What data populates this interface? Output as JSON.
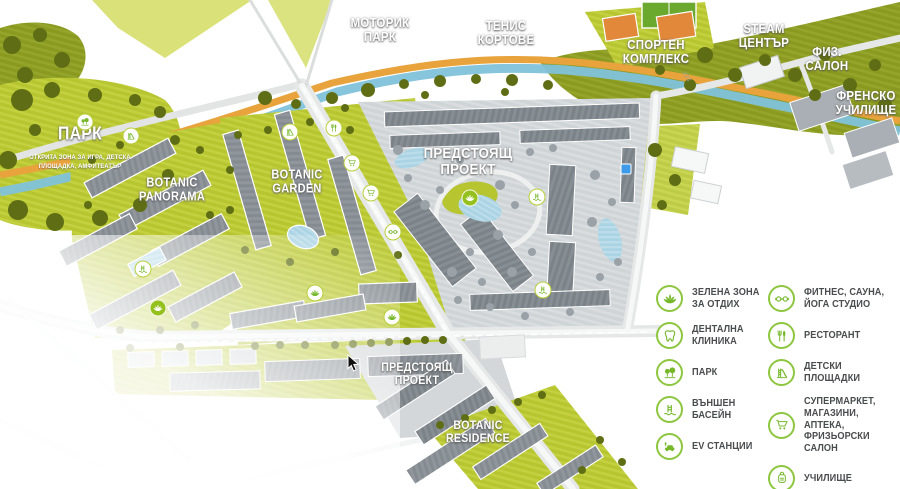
{
  "colors": {
    "accent_green": "#8dc63f",
    "icon_green": "#76b82a",
    "legend_text": "#4b4c4e",
    "lime": "#b7c531",
    "olive": "#8a991f",
    "tree_olive": "#5f6e15",
    "river_blue": "#7fc2da",
    "path_orange": "#e8a33d",
    "road_gray": "#e6e8e8",
    "building_gray": "#90969c",
    "upcoming_gray": "#cfd4d6",
    "pool_blue": "#aad4e4",
    "marker_ring": "#b9cf3a"
  },
  "map": {
    "area_labels": [
      {
        "id": "motorik-park",
        "text": "МОТОРИК\nПАРК",
        "x": 380,
        "y": 30,
        "size": 13
      },
      {
        "id": "tenis-kortove",
        "text": "ТЕНИС\nКОРТОВЕ",
        "x": 506,
        "y": 33,
        "size": 13
      },
      {
        "id": "sporten-kompleks",
        "text": "СПОРТЕН\nКОМПЛЕКС",
        "x": 656,
        "y": 52,
        "size": 13
      },
      {
        "id": "steam-centar",
        "text": "STEAM\nЦЕНТЪР",
        "x": 764,
        "y": 36,
        "size": 13
      },
      {
        "id": "fiz-salon",
        "text": "ФИЗ.\nСАЛОН",
        "x": 827,
        "y": 59,
        "size": 13
      },
      {
        "id": "frensko-uchilishte",
        "text": "ФРЕНСКО\nУЧИЛИЩЕ",
        "x": 866,
        "y": 103,
        "size": 13
      },
      {
        "id": "park",
        "text": "ПАРК",
        "x": 80,
        "y": 134,
        "size": 18
      },
      {
        "id": "park-subtitle",
        "text": "ОТКРИТА ЗОНА ЗА ИГРА, ДЕТСКА\nПЛОЩАДКА, АМФИТЕАТЪР",
        "x": 80,
        "y": 163,
        "size": 6.5,
        "variant": "sub"
      },
      {
        "id": "botanic-panorama",
        "text": "BOTANIC\nPANORAMA",
        "x": 172,
        "y": 190,
        "size": 12.5
      },
      {
        "id": "botanic-garden",
        "text": "BOTANIC\nGARDEN",
        "x": 297,
        "y": 182,
        "size": 12.5
      },
      {
        "id": "predstoyasht-proekt",
        "text": "ПРЕДСТОЯЩ\nПРОЕКТ",
        "x": 468,
        "y": 162,
        "size": 15
      },
      {
        "id": "predstoyasht-proekt-south",
        "text": "ПРЕДСТОЯЩ\nПРОЕКТ",
        "x": 417,
        "y": 374,
        "size": 12
      },
      {
        "id": "botanic-residence",
        "text": "BOTANIC\nRESIDENCE",
        "x": 478,
        "y": 432,
        "size": 12
      },
      {
        "id": "road-223",
        "text": "223",
        "x": 686,
        "y": 77,
        "size": 6,
        "variant": "road"
      }
    ],
    "markers": [
      {
        "icon": "park-trees",
        "x": 85,
        "y": 122,
        "variant": "white"
      },
      {
        "icon": "playground-slide",
        "x": 131,
        "y": 136,
        "variant": "white"
      },
      {
        "icon": "playground-slide",
        "x": 290,
        "y": 132,
        "variant": "white"
      },
      {
        "icon": "restaurant",
        "x": 334,
        "y": 128,
        "variant": "white"
      },
      {
        "icon": "supermarket-cart",
        "x": 352,
        "y": 163,
        "variant": "white"
      },
      {
        "icon": "supermarket-cart",
        "x": 371,
        "y": 193,
        "variant": "white"
      },
      {
        "icon": "dumbbell",
        "x": 393,
        "y": 232,
        "variant": "white"
      },
      {
        "icon": "pool-ladder",
        "x": 143,
        "y": 269,
        "variant": "white"
      },
      {
        "icon": "lotus",
        "x": 158,
        "y": 308,
        "variant": "green"
      },
      {
        "icon": "lotus",
        "x": 315,
        "y": 293,
        "variant": "white"
      },
      {
        "icon": "lotus",
        "x": 392,
        "y": 317,
        "variant": "white"
      },
      {
        "icon": "lotus",
        "x": 470,
        "y": 198,
        "variant": "green"
      },
      {
        "icon": "pool-ladder",
        "x": 537,
        "y": 197,
        "variant": "white"
      },
      {
        "icon": "pool-ladder",
        "x": 543,
        "y": 290,
        "variant": "white"
      }
    ],
    "blue_marker": {
      "x": 626,
      "y": 169
    }
  },
  "legend": {
    "columns": [
      {
        "items": [
          {
            "icon": "lotus",
            "label": "ЗЕЛЕНА ЗОНА\nЗА ОТДИХ"
          },
          {
            "icon": "tooth",
            "label": "ДЕНТАЛНА\nКЛИНИКА"
          },
          {
            "icon": "park-trees",
            "label": "ПАРК"
          },
          {
            "icon": "pool-ladder",
            "label": "ВЪНШЕН\nБАСЕЙН"
          },
          {
            "icon": "ev-station",
            "label": "EV СТАНЦИИ"
          }
        ]
      },
      {
        "items": [
          {
            "icon": "dumbbell",
            "label": "ФИТНЕС, САУНА,\nЙОГА СТУДИО"
          },
          {
            "icon": "restaurant",
            "label": "РЕСТОРАНТ"
          },
          {
            "icon": "playground-slide",
            "label": "ДЕТСКИ\nПЛОЩАДКИ"
          },
          {
            "icon": "supermarket-cart",
            "label": "СУПЕРМАРКЕТ,\nМАГАЗИНИ, АПТЕКА,\nФРИЗЬОРСКИ САЛОН"
          },
          {
            "icon": "school-backpack",
            "label": "УЧИЛИЩЕ"
          }
        ]
      }
    ]
  },
  "cursor": {
    "x": 347,
    "y": 354
  }
}
